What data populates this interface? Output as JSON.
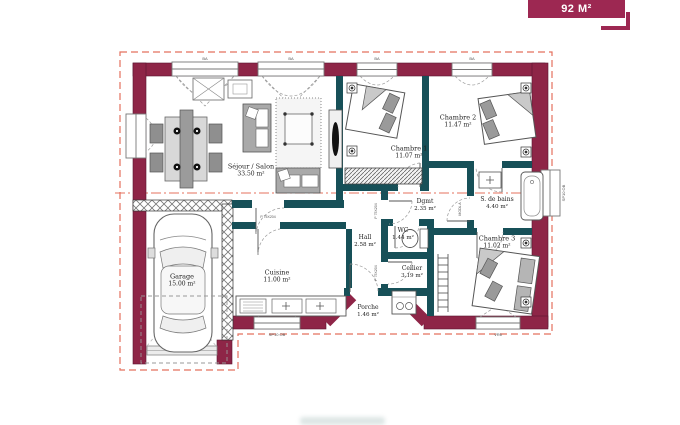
{
  "badge": {
    "label": "92 M²"
  },
  "plan": {
    "rooms": [
      {
        "name": "Séjour / Salon",
        "area": "33.50 m²"
      },
      {
        "name": "Cuisine",
        "area": "11.00 m²"
      },
      {
        "name": "Garage",
        "area": "15.00 m²"
      },
      {
        "name": "Chambre 1",
        "area": "11.07 m²"
      },
      {
        "name": "Chambre 2",
        "area": "11.47 m²"
      },
      {
        "name": "Chambre 3",
        "area": "11.02 m²"
      },
      {
        "name": "S. de bains",
        "area": "4.40 m²"
      },
      {
        "name": "Dgmt",
        "area": "2.35 m²"
      },
      {
        "name": "WC",
        "area": "1.44 m²"
      },
      {
        "name": "Hall",
        "area": "2.58 m²"
      },
      {
        "name": "Cellier",
        "area": "3.19 m²"
      },
      {
        "name": "Porche",
        "area": "1.46 m²"
      }
    ],
    "codes": {
      "window_top": "BA",
      "window_side": "SP10 OB",
      "window_rear": "VR6",
      "door": "P 75X204",
      "bath_door": "MODL A"
    },
    "colors": {
      "exterior_wall": "#8e2547",
      "interior_wall": "#175058",
      "roof_line": "#e4705d",
      "badge": "#9d2852"
    }
  }
}
